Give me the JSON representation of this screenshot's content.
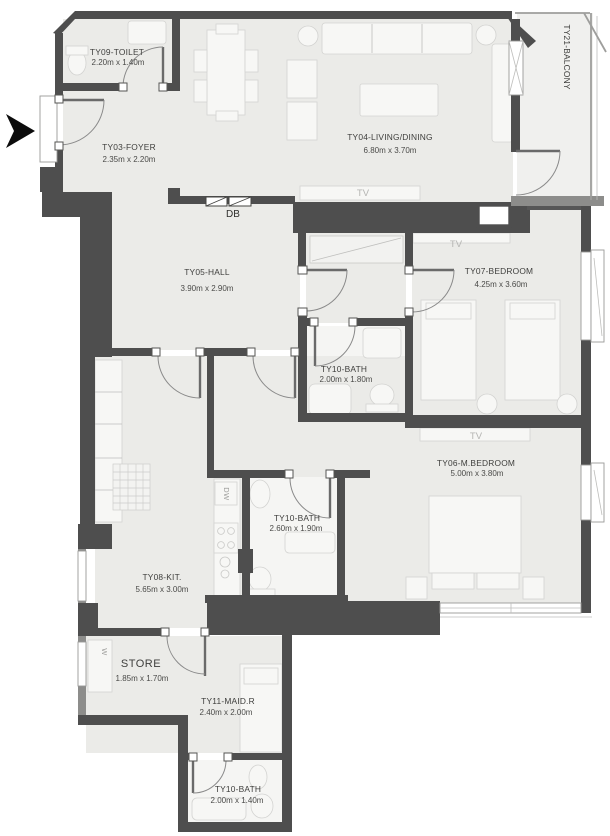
{
  "plan": {
    "rooms": {
      "toilet": {
        "name": "TY09-TOILET",
        "dims": "2.20m x 1.40m"
      },
      "foyer": {
        "name": "TY03-FOYER",
        "dims": "2.35m x 2.20m"
      },
      "living_dining": {
        "name": "TY04-LIVING/DINING",
        "dims": "6.80m x 3.70m"
      },
      "balcony": {
        "name": "TY21-BALCONY"
      },
      "hall": {
        "name": "TY05-HALL",
        "dims": "3.90m x 2.90m"
      },
      "bedroom": {
        "name": "TY07-BEDROOM",
        "dims": "4.25m x 3.60m"
      },
      "bath_hall": {
        "name": "TY10-BATH",
        "dims": "2.00m x 1.80m"
      },
      "master_bedroom": {
        "name": "TY06-M.BEDROOM",
        "dims": "5.00m x 3.80m"
      },
      "bath_master": {
        "name": "TY10-BATH",
        "dims": "2.60m x 1.90m"
      },
      "kitchen": {
        "name": "TY08-KIT.",
        "dims": "5.65m x 3.00m"
      },
      "store": {
        "name": "STORE",
        "dims": "1.85m x 1.70m"
      },
      "maid_room": {
        "name": "TY11-MAID.R",
        "dims": "2.40m x 2.00m"
      },
      "bath_maid": {
        "name": "TY10-BATH",
        "dims": "2.00m x 1.40m"
      }
    },
    "annotations": {
      "distribution_board": "DB",
      "dishwasher": "DW",
      "washer": "W",
      "tv": "TV"
    },
    "colors": {
      "wall": "#4e4e4e",
      "floor": "#ebebe8",
      "bath_floor": "#f5f5f3",
      "label_text": "#3e3e3c",
      "light_anno": "#b4b4b2"
    }
  }
}
